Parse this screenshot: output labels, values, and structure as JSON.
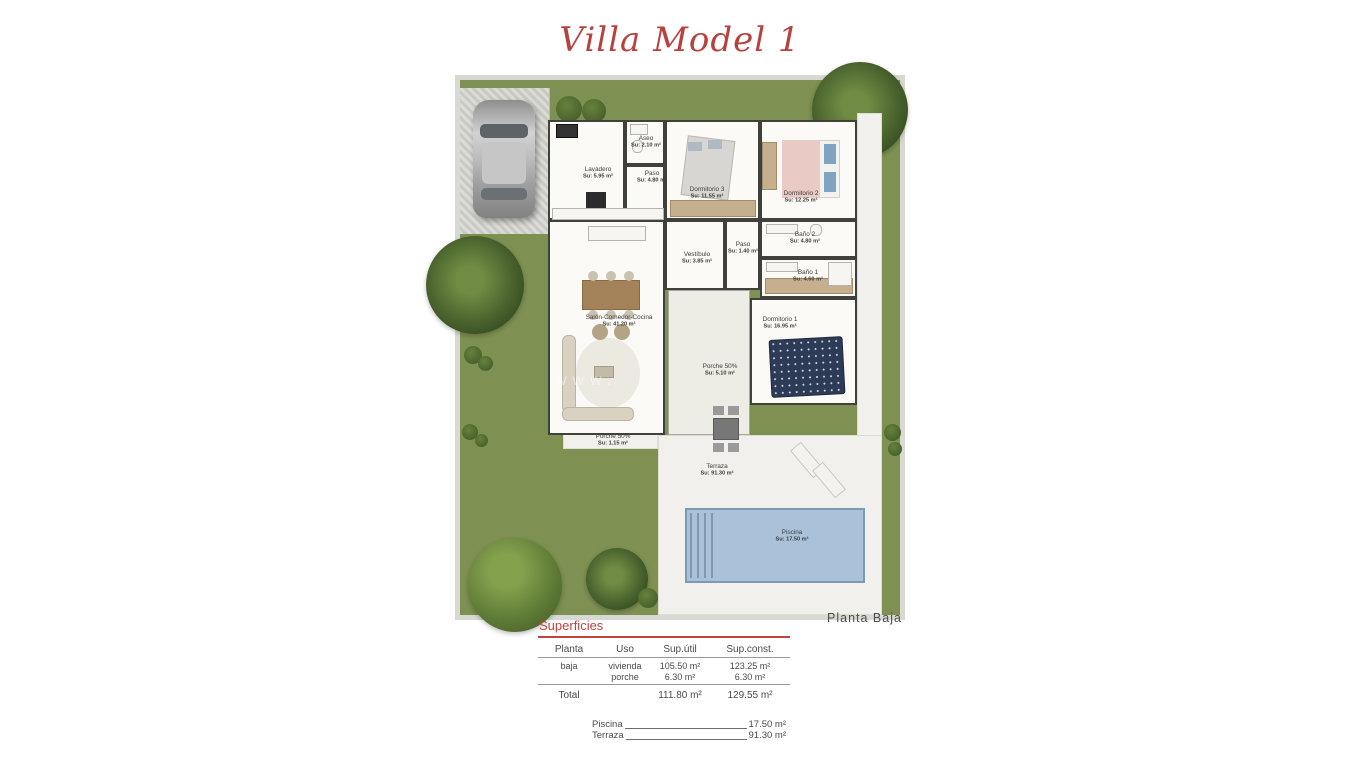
{
  "title": "Villa Model 1",
  "plan_label": "Planta Baja",
  "watermark": "www.",
  "rooms": [
    {
      "name": "Lavadero",
      "area": "Su: 5.95 m²"
    },
    {
      "name": "Aseo",
      "area": "Su: 2.10 m²"
    },
    {
      "name": "Paso",
      "area": "Su: 4.80 m²"
    },
    {
      "name": "Dormitorio 3",
      "area": "Su: 11.55 m²"
    },
    {
      "name": "Dormitorio 2",
      "area": "Su: 12.25 m²"
    },
    {
      "name": "Baño 2",
      "area": "Su: 4.80 m²"
    },
    {
      "name": "Paso",
      "area": "Su: 1.40 m²"
    },
    {
      "name": "Vestíbulo",
      "area": "Su: 3.85 m²"
    },
    {
      "name": "Baño 1",
      "area": "Su: 4.60 m²"
    },
    {
      "name": "Dormitorio 1",
      "area": "Su: 16.95 m²"
    },
    {
      "name": "Salón-Comedor-Cocina",
      "area": "Su: 41.20 m²"
    },
    {
      "name": "Porche 50%",
      "area": "Su: 5.10 m²"
    },
    {
      "name": "Porche 50%",
      "area": "Su: 1.15 m²"
    },
    {
      "name": "Terraza",
      "area": "Su: 91.30 m²"
    },
    {
      "name": "Piscina",
      "area": "Su: 17.50 m²"
    }
  ],
  "superficies": {
    "heading": "Superficies",
    "columns": [
      "Planta",
      "Uso",
      "Sup.útil",
      "Sup.const."
    ],
    "rows": [
      {
        "planta": "baja",
        "uso": "vivienda",
        "util": "105.50 m²",
        "const": "123.25 m²"
      },
      {
        "planta": "",
        "uso": "porche",
        "util": "6.30 m²",
        "const": "6.30 m²"
      }
    ],
    "total_label": "Total",
    "total_util": "111.80 m²",
    "total_const": "129.55 m²",
    "extras": [
      {
        "label": "Piscina",
        "value": "17.50 m²"
      },
      {
        "label": "Terraza",
        "value": "91.30 m²"
      }
    ]
  },
  "colors": {
    "accent_red": "#b9413d",
    "garden_green": "#7e9052",
    "pool_blue": "#a9c2d9",
    "wall_dark": "#40403d"
  }
}
